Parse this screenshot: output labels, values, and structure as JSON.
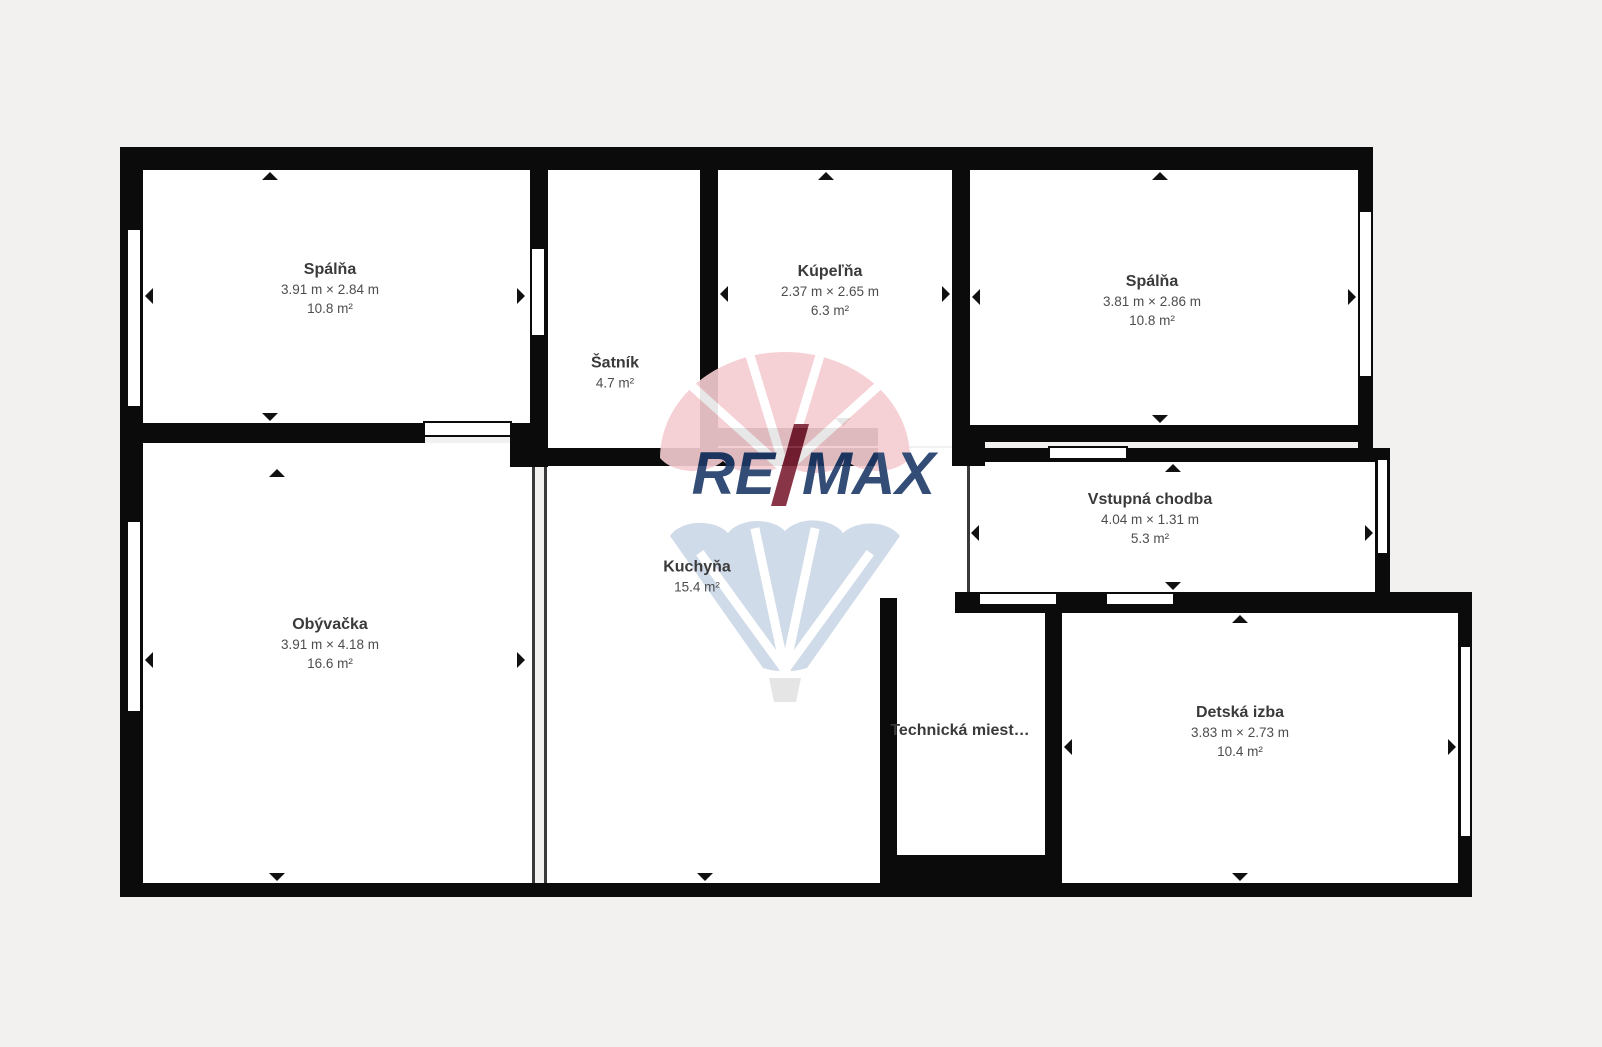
{
  "page": {
    "background": "#f2f1ef",
    "wall_color": "#0b0b0b",
    "room_fill": "#ffffff",
    "label_color": "#3e3e3e"
  },
  "rooms": [
    {
      "name": "Spálňa",
      "dimensions": "3.91 m × 2.84 m",
      "area": "10.8 m²"
    },
    {
      "name": "Šatník",
      "dimensions": "",
      "area": "4.7 m²"
    },
    {
      "name": "Kúpeľňa",
      "dimensions": "2.37 m × 2.65 m",
      "area": "6.3 m²"
    },
    {
      "name": "Spálňa",
      "dimensions": "3.81 m × 2.86 m",
      "area": "10.8 m²"
    },
    {
      "name": "Vstupná chodba",
      "dimensions": "4.04 m × 1.31 m",
      "area": "5.3 m²"
    },
    {
      "name": "Kuchyňa",
      "dimensions": "",
      "area": "15.4 m²"
    },
    {
      "name": "Obývačka",
      "dimensions": "3.91 m × 4.18 m",
      "area": "16.6 m²"
    },
    {
      "name": "Technická miest…",
      "dimensions": "",
      "area": ""
    },
    {
      "name": "Detská izba",
      "dimensions": "3.83 m × 2.73 m",
      "area": "10.4 m²"
    }
  ],
  "watermark": {
    "brand": "RE/MAX",
    "re": "RE",
    "max": "MAX",
    "balloon_top_color": "#f5cdd2",
    "balloon_bottom_color": "#ccd8e7",
    "text_color": "#1d3a69",
    "slash_color": "#7c2134",
    "basket_color": "#e3e3e3"
  }
}
